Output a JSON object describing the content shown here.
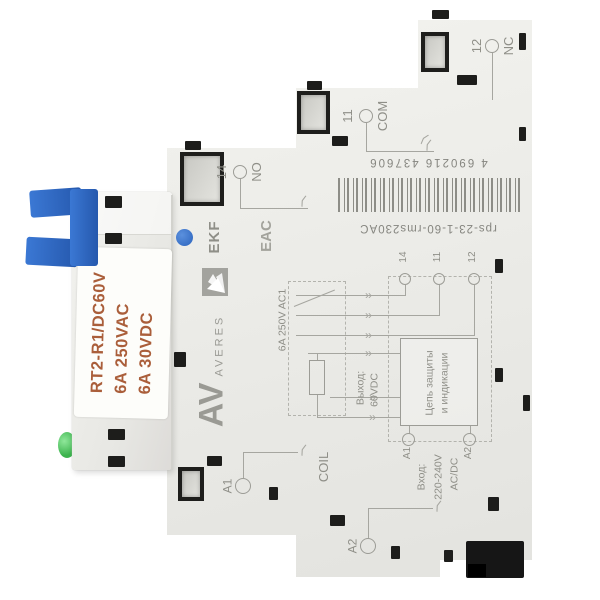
{
  "device": {
    "relay": {
      "model": "RT2-R1/DC60V",
      "rating_ac": "6A 250VAC",
      "rating_dc": "6A 30VDC"
    },
    "branding": {
      "ekf": "EKF",
      "averes_abbr": "AV",
      "averes": "AVERES",
      "cert_mark": "EAC"
    },
    "barcode": {
      "digits": "4 690216 437606",
      "product_code": "rps-23-1-60-rms230AC"
    },
    "terminal_markings": {
      "no_number": "14",
      "no_label": "NO",
      "com_number": "11",
      "com_label": "COM",
      "nc_number": "12",
      "nc_label": "NC",
      "coil_label": "COIL",
      "coil_a1": "A1",
      "coil_a2": "A2"
    },
    "schematic": {
      "contact_rating": "6A 250V AC1",
      "output_label": "Выход:",
      "output_value": "60VDC",
      "protection_line1": "Цепь защиты",
      "protection_line2": "и индикации",
      "input_label": "Вход:",
      "input_value": "220-240V",
      "input_type": "AC/DC",
      "terminal_14": "14",
      "terminal_11": "11",
      "terminal_12": "12",
      "terminal_a1": "A1",
      "terminal_a2": "A2"
    },
    "icons": {
      "contact_arrow": "››",
      "fork": "⟨"
    },
    "colors": {
      "clip_blue": "#2e6ac6",
      "indicator_blue": "#2c64bd",
      "led_green": "#3cb34d",
      "label_text_orange": "#aa5e3a",
      "print_gray": "#8f8f88",
      "body_gray": "#ecece8"
    }
  }
}
